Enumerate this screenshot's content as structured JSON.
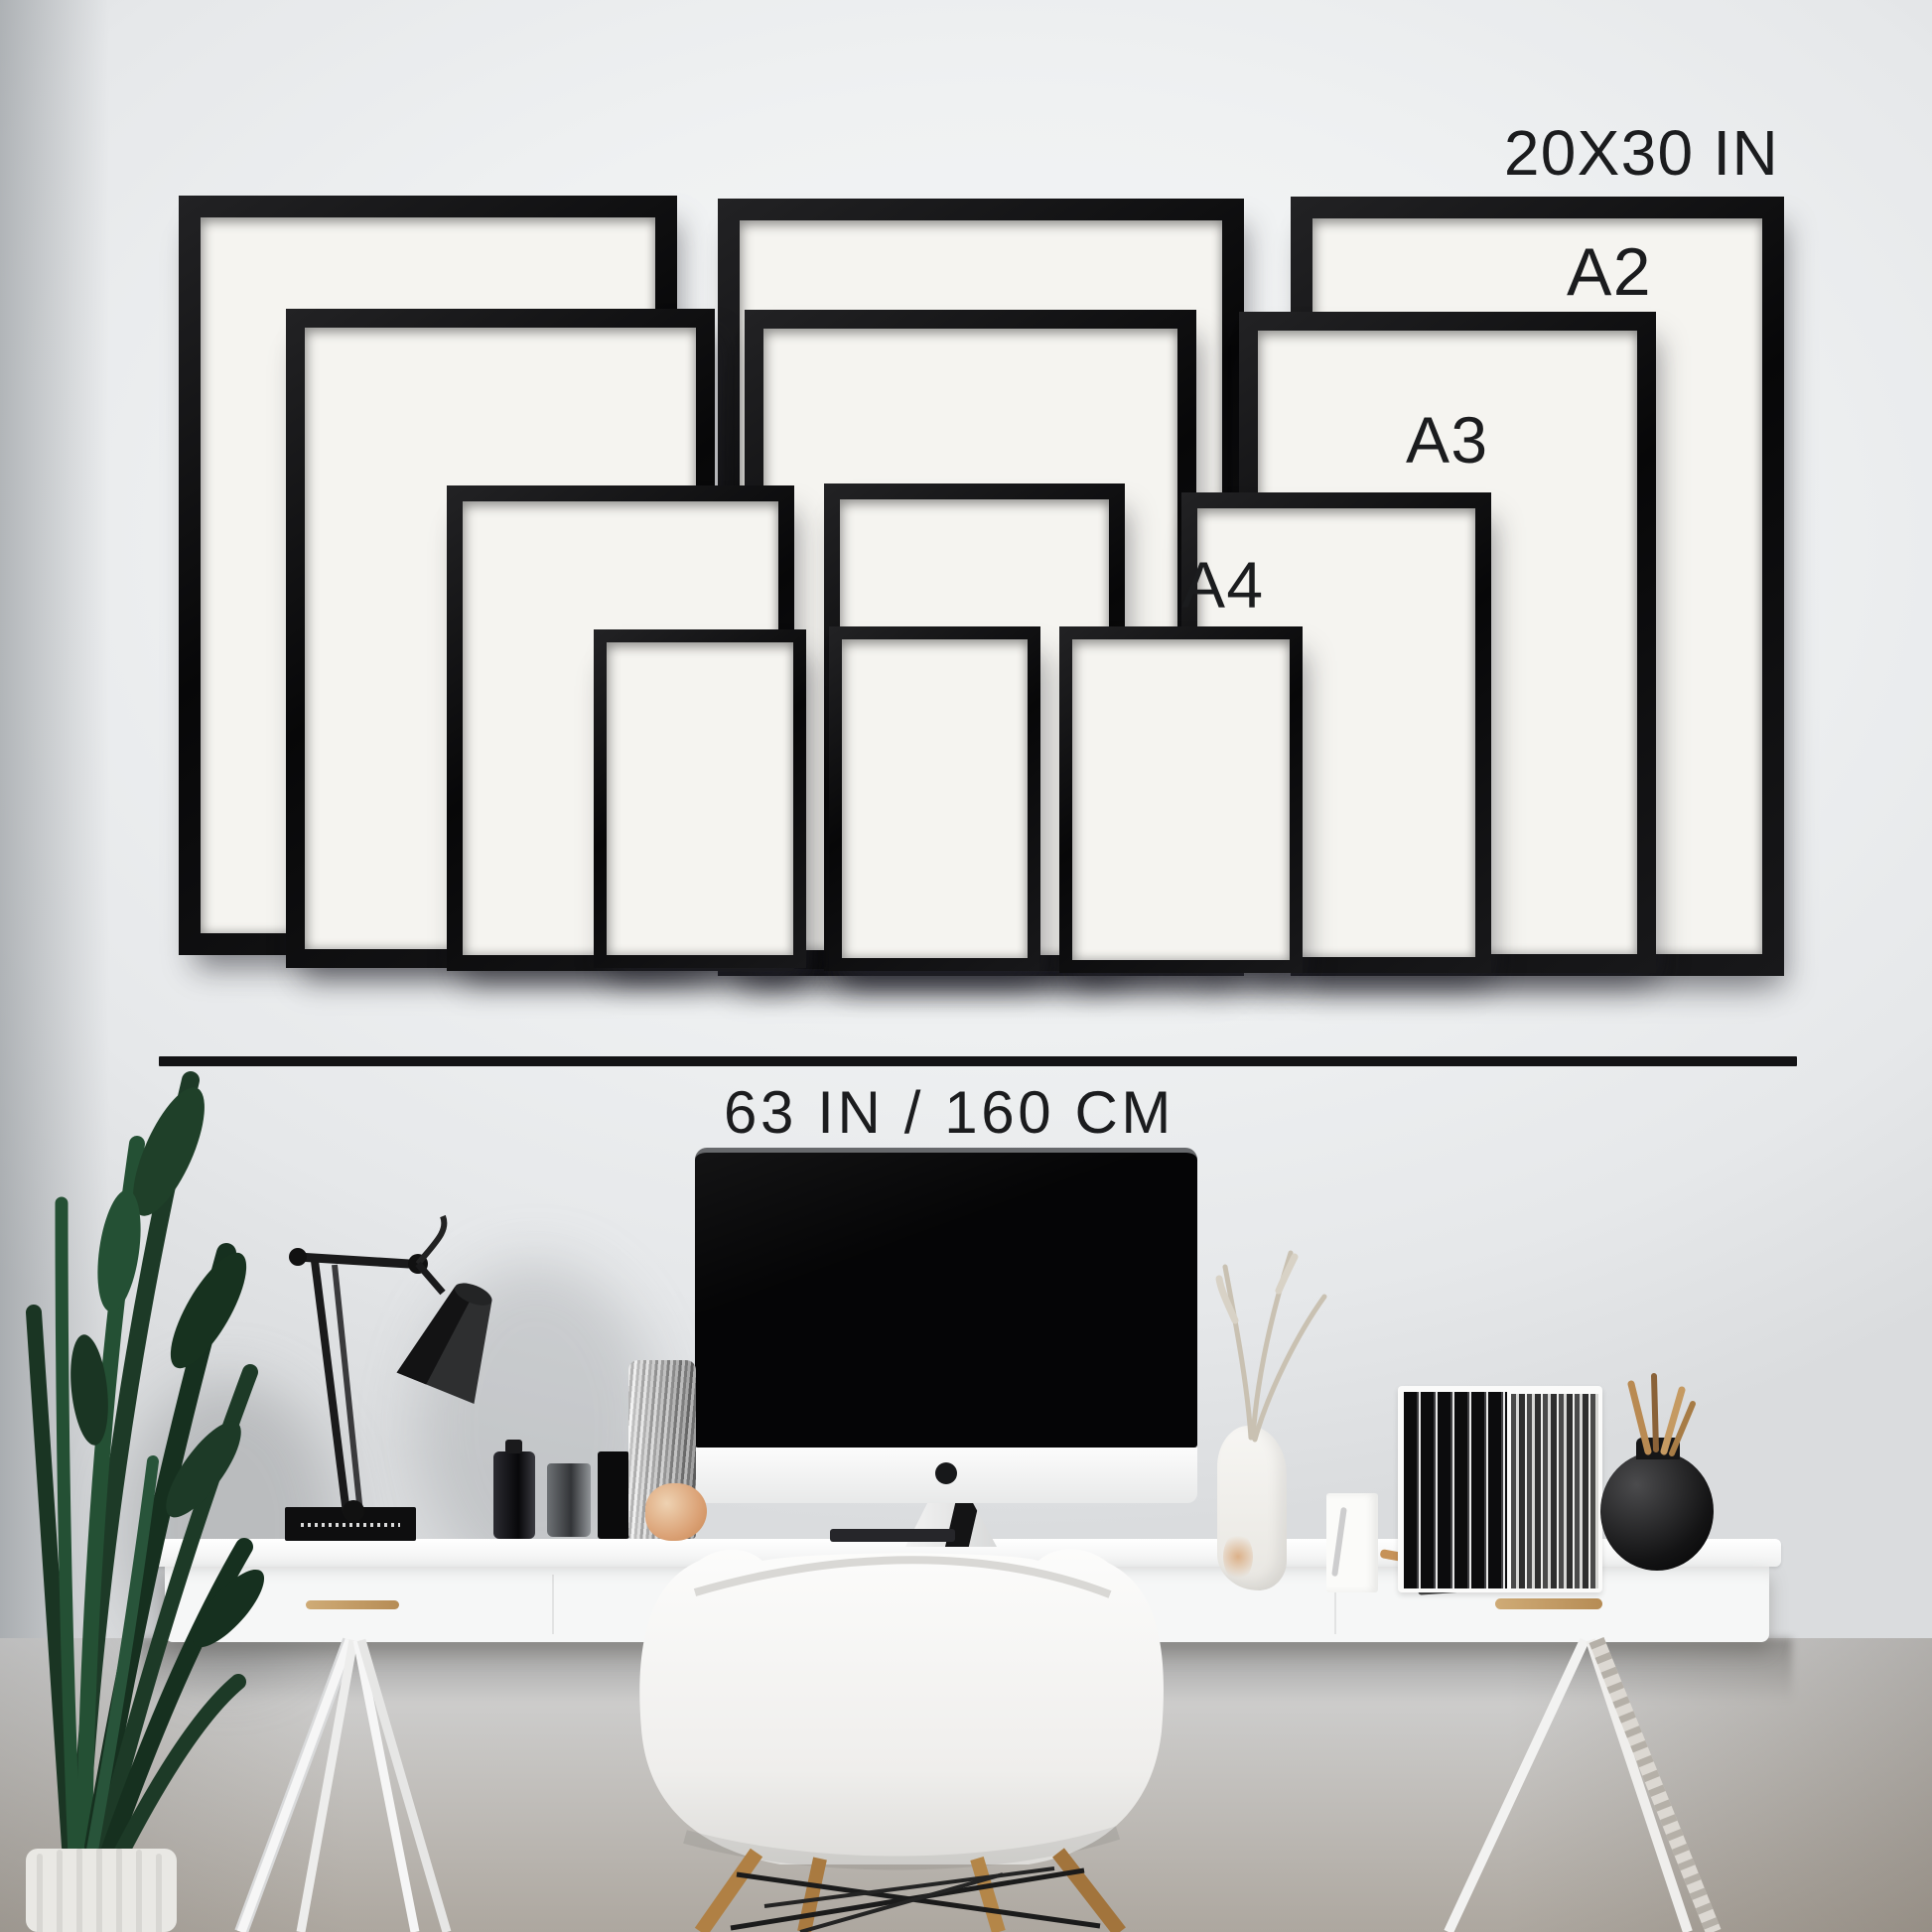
{
  "scene": {
    "description": "Gallery wall size guide mockup: twelve black picture frames in four sizes above a white trestle desk workspace"
  },
  "labels": {
    "largest_size": "20X30 IN",
    "a2": "A2",
    "a3": "A3",
    "a4": "A4",
    "total_width": "63 IN / 160 CM"
  },
  "frames": {
    "sizes": [
      "20X30 IN",
      "A2",
      "A3",
      "A4"
    ],
    "count_per_size": 3,
    "total": 12,
    "frame_color": "#0f0f10",
    "mat_color": "#f5f4f0"
  },
  "colors": {
    "wall_upper": "#edeff0",
    "wall_lower": "#ada79f",
    "text": "#1b1c1e",
    "divider": "#131315",
    "desk": "#f6f7f7",
    "wood_accent": "#c9a36b",
    "plant_green": "#1d3a27"
  },
  "objects": [
    "palm-plant",
    "plant-pot",
    "task-lamp",
    "black-book",
    "cosmetic-bottles",
    "smoked-glass-vase",
    "textured-silver-vase",
    "peach-ornament",
    "imac-monitor",
    "keyboard",
    "eames-armchair",
    "white-sculpture-vase",
    "dried-branches",
    "marble-block",
    "wood-figurine",
    "black-folders",
    "striped-folders",
    "round-black-vase",
    "wood-sticks",
    "white-desk",
    "trestle-legs",
    "drawer-handles"
  ]
}
